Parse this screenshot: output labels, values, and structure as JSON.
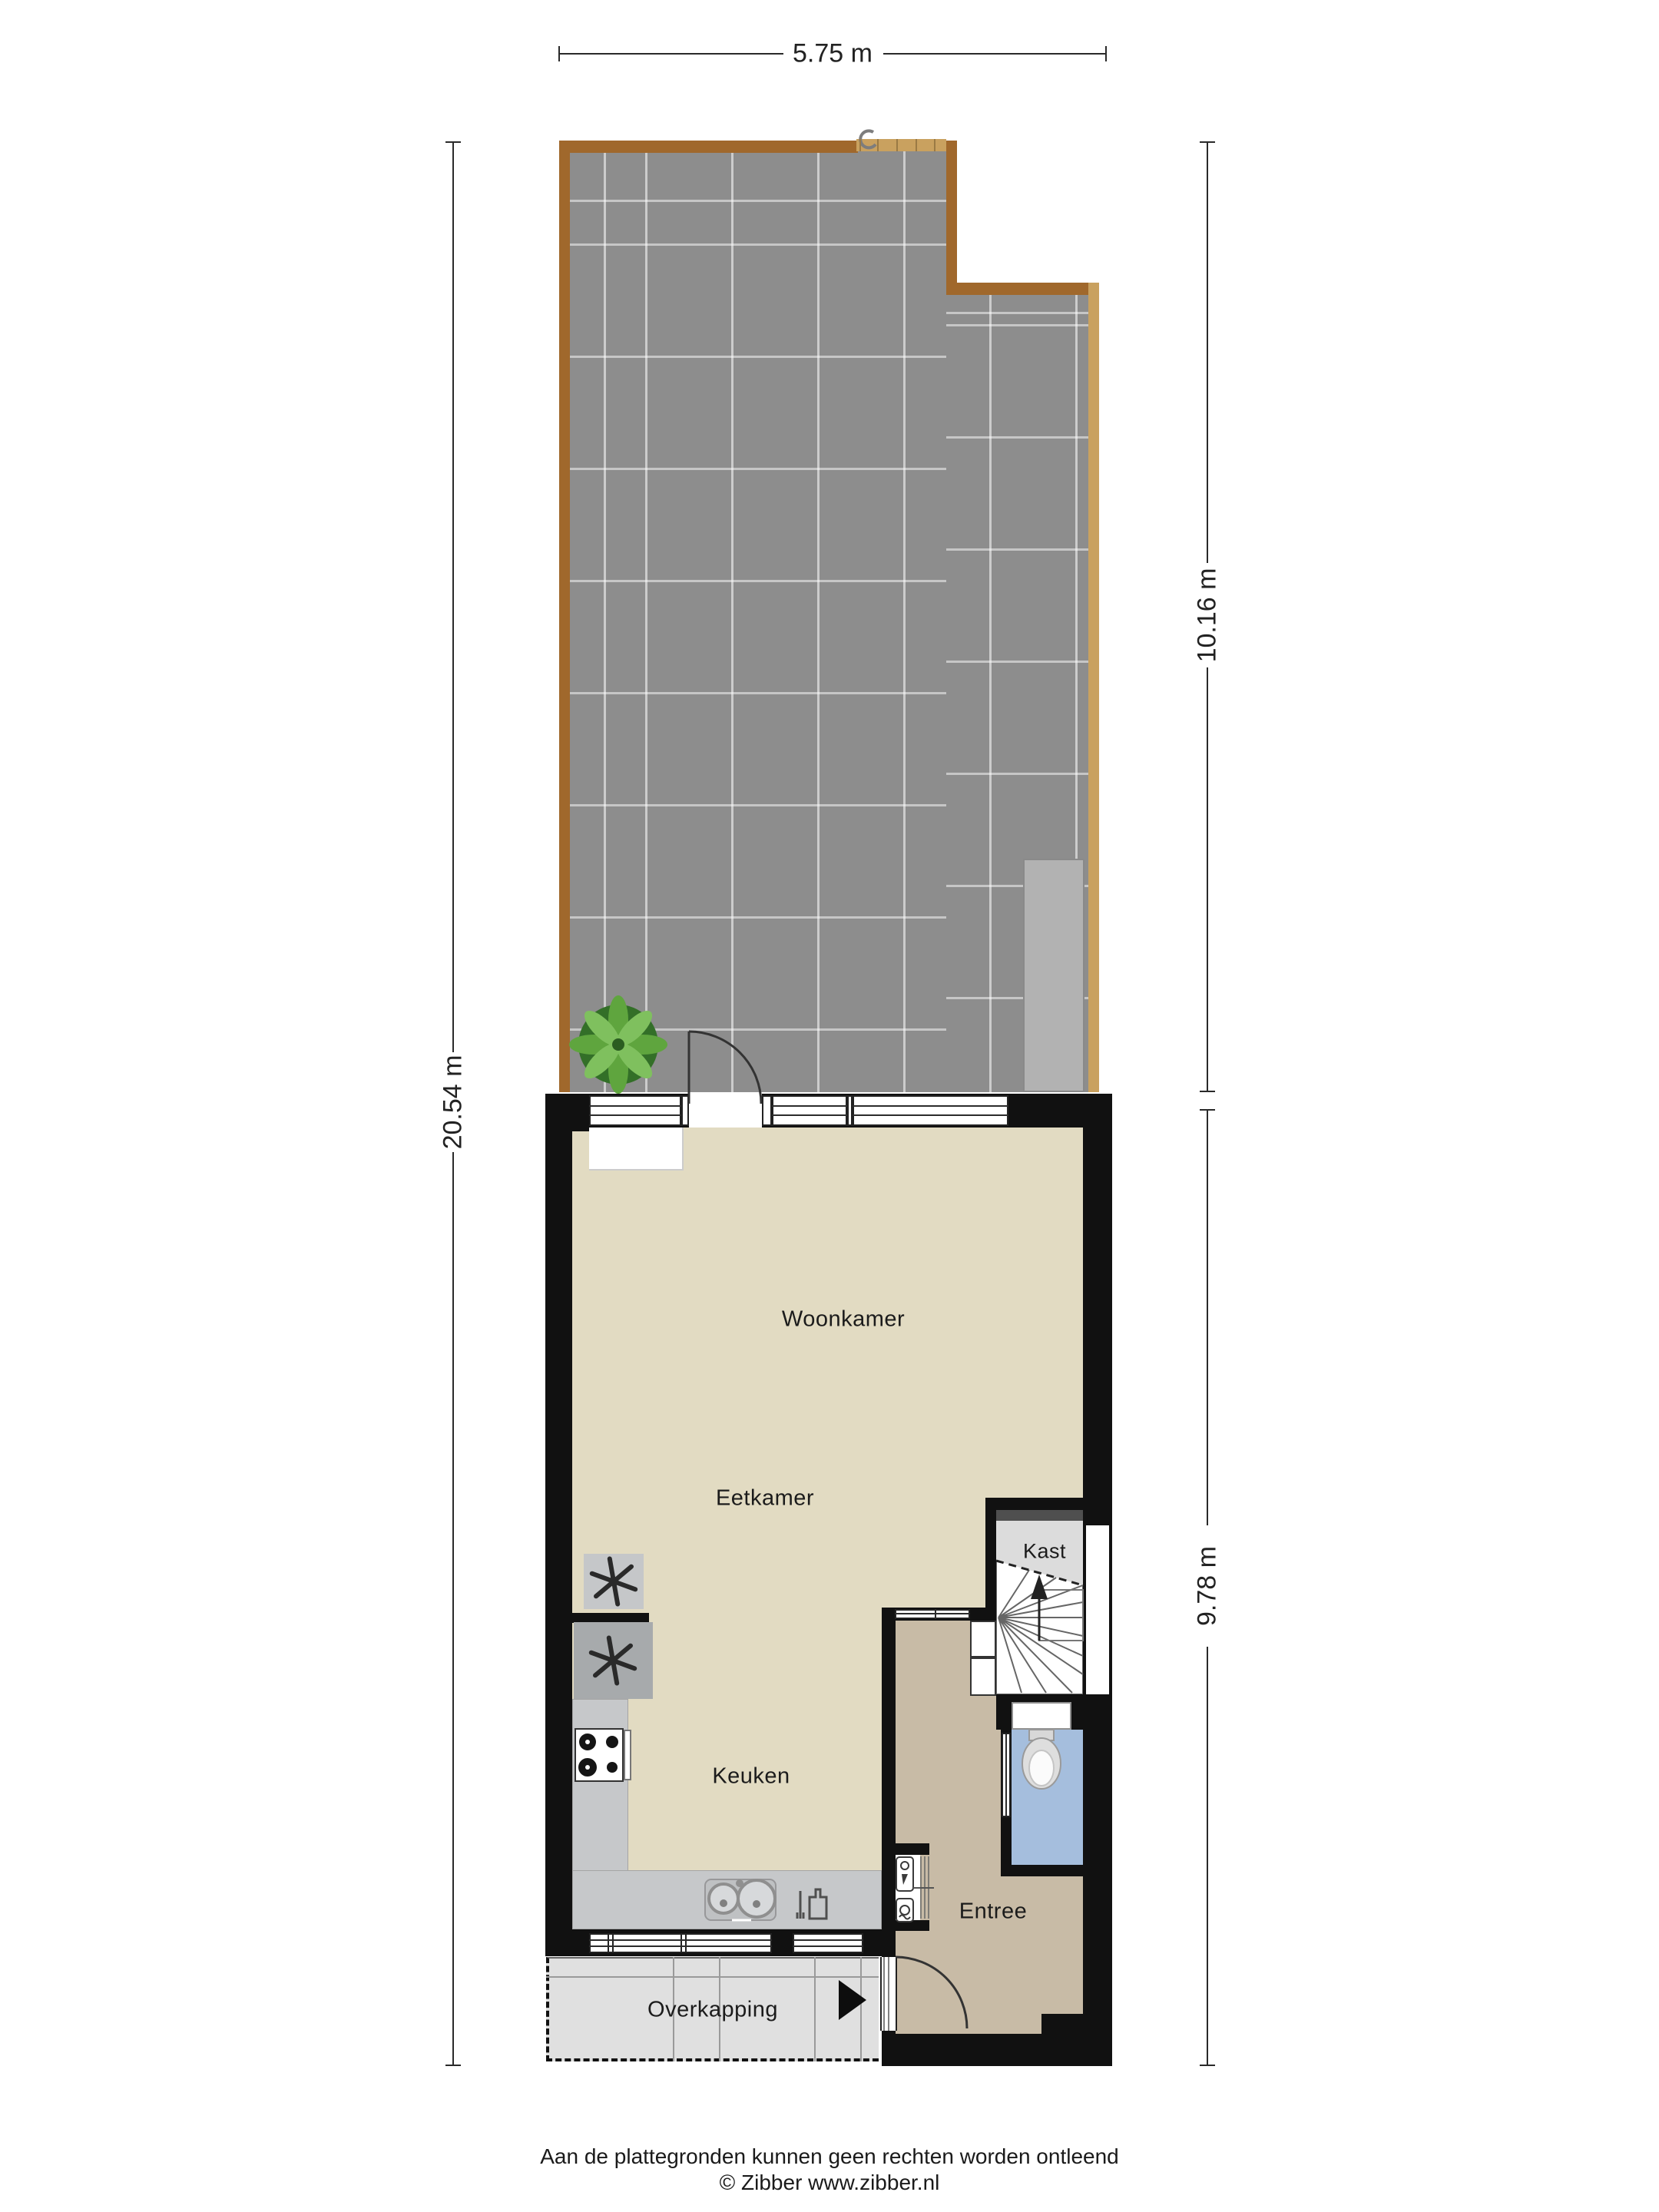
{
  "dimensions": {
    "top": "5.75 m",
    "left": "20.54 m",
    "right_upper": "10.16 m",
    "right_lower": "9.78 m"
  },
  "rooms": {
    "woonkamer": "Woonkamer",
    "eetkamer": "Eetkamer",
    "keuken": "Keuken",
    "kast": "Kast",
    "entree": "Entree",
    "overkapping": "Overkapping"
  },
  "footer": {
    "disclaimer": "Aan de plattegronden kunnen geen rechten worden ontleend",
    "copyright": "© Zibber www.zibber.nl"
  },
  "colors": {
    "wall": "#111111",
    "floor_main": "#e2dbc2",
    "floor_entree": "#c8bba6",
    "floor_kast": "#dcdcdc",
    "floor_toilet": "#a5bedd",
    "garden_tile": "#8d8d8d",
    "garden_border_wood": "#a0682c",
    "garden_border_light": "#c9a15f",
    "shed": "#b2b2b2",
    "counter": "#c6c8ca",
    "fan_unit_light": "#c5c7c9",
    "fan_unit_dark": "#a7aaac",
    "wardrobe": "#4f4f4f",
    "overkapping": "#e0e0e0",
    "dimension_line": "#2a2a2a"
  },
  "icons": {
    "plant": "plant-top-view",
    "toilet": "toilet-top-view",
    "sink": "double-round-sink",
    "cooktop": "four-burner-cooktop",
    "dishwasher": "dishwasher-glyph",
    "ventilation": "fan-asterisk",
    "electric_meter": "meter-box-bolt",
    "water_meter": "meter-box-dial",
    "stairs_arrow": "stairs-up-arrow",
    "entrance_arrow": "entrance-direction-arrow",
    "gate_hook": "gate-hook"
  }
}
